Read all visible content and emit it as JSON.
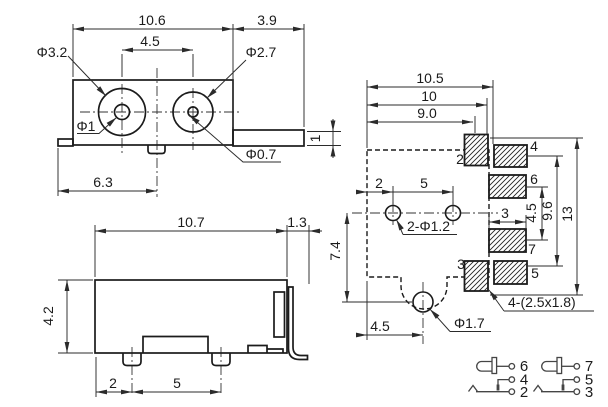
{
  "front": {
    "width": "10.6",
    "pin_len": "3.9",
    "hole_pitch": "4.5",
    "left_outer": "Φ3.2",
    "right_outer": "Φ2.7",
    "left_inner": "Φ1",
    "right_inner": "Φ0.7",
    "bottom": "6.3",
    "pin_th": "1"
  },
  "side": {
    "width": "10.7",
    "pin_len": "1.3",
    "height": "4.2",
    "foot_offset": "2",
    "foot_pitch": "5"
  },
  "pcb": {
    "w_outer": "10.5",
    "w_mid": "10",
    "w_inner": "9.0",
    "hole_offset": "2",
    "hole_pitch": "5",
    "hole_note": "2-Φ1.2",
    "depth": "7.4",
    "pad_len": "3",
    "pad_gap": "4.5",
    "pad_span": "9.6",
    "total": "13",
    "hole_x": "4.5",
    "hole_dia": "Φ1.7",
    "pad_note": "4-(2.5x1.8)",
    "pin2": "2",
    "pin3": "3",
    "pin4": "4",
    "pin5": "5",
    "pin6": "6",
    "pin7": "7"
  },
  "schematic": {
    "left": {
      "top": "6",
      "mid": "4",
      "bot": "2"
    },
    "right": {
      "top": "7",
      "mid": "5",
      "bot": "3"
    }
  }
}
